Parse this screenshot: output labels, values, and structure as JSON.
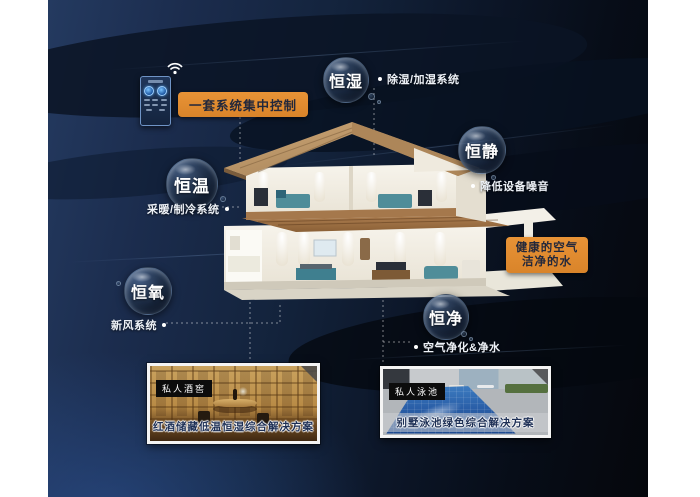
{
  "scene": {
    "title": "smart-home-five-constants-infographic",
    "accent_orange": "#de8b2e",
    "panel_dark": "#0b1322",
    "panel_blue": "#1f3a64",
    "text_light": "#eef2f8",
    "caption_navy": "#1d2f55"
  },
  "control": {
    "pill_label": "一套系统集中控制",
    "device_icon": "wifi-icon"
  },
  "bubbles": [
    {
      "id": "heng-shi",
      "label": "恒湿"
    },
    {
      "id": "heng-jing",
      "label": "恒静"
    },
    {
      "id": "heng-wen",
      "label": "恒温"
    },
    {
      "id": "heng-yang",
      "label": "恒氧"
    },
    {
      "id": "heng-jing2",
      "label": "恒净"
    }
  ],
  "notes": [
    {
      "for": "heng-shi",
      "text": "除湿/加湿系统"
    },
    {
      "for": "heng-jing",
      "text": "降低设备噪音"
    },
    {
      "for": "heng-wen",
      "text": "采暖/制冷系统"
    },
    {
      "for": "heng-yang",
      "text": "新风系统"
    },
    {
      "for": "heng-jing2",
      "text": "空气净化&净水"
    }
  ],
  "highlight_box": {
    "line1": "健康的空气",
    "line2": "洁净的水"
  },
  "cards": [
    {
      "tag": "私人酒窖",
      "caption": "红酒储藏低温恒湿综合解决方案"
    },
    {
      "tag": "私人泳池",
      "caption": "别墅泳池绿色综合解决方案"
    }
  ]
}
